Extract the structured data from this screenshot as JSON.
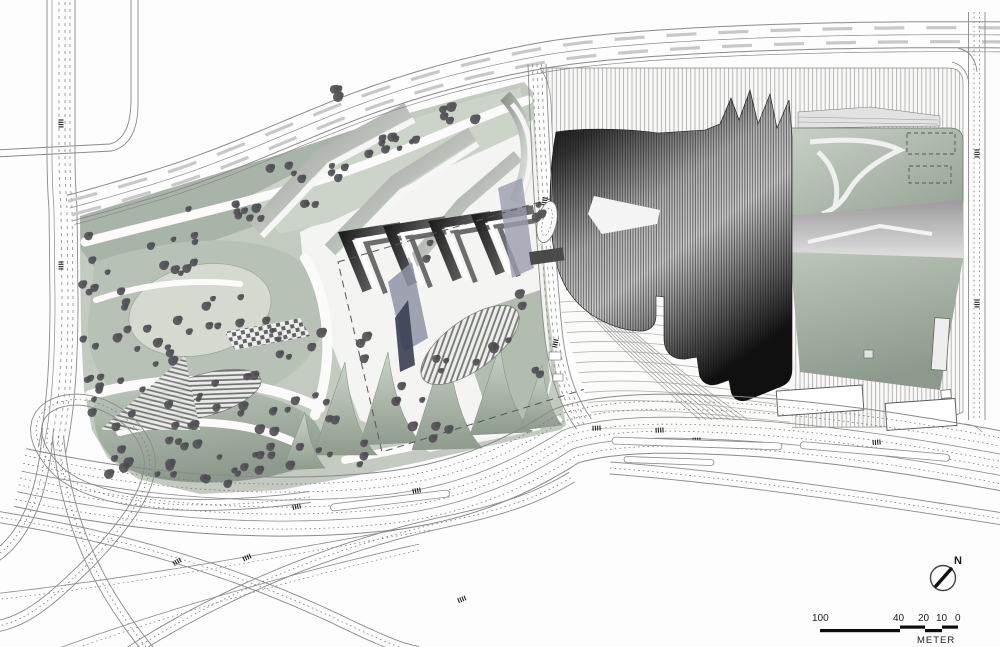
{
  "scale_bar": {
    "labels": [
      "100",
      "40",
      "20",
      "10",
      "0"
    ],
    "unit": "METER"
  },
  "north_arrow": {
    "label": "N"
  },
  "palette": {
    "background": "#fdfdfd",
    "landscape": "#c3cbc1",
    "landscape_dark": "#97a496",
    "landscape_pale": "#d4dad0",
    "building_dark": "#141414",
    "road_line": "#8a8a8a",
    "tree": "#545456",
    "hatch": "#a2a2a2"
  }
}
